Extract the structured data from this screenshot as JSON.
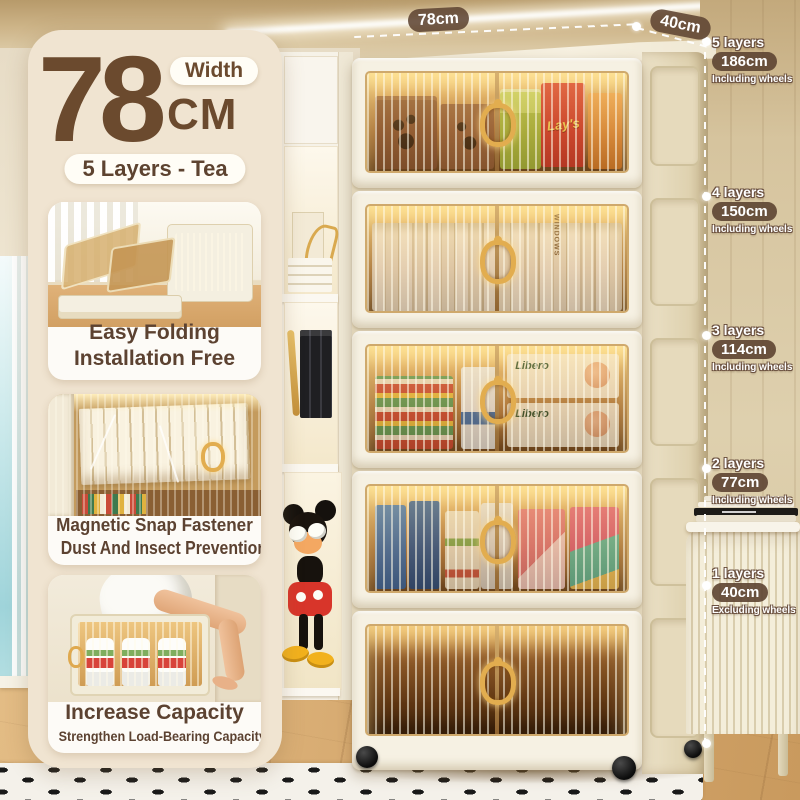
{
  "header": {
    "size_value": "78",
    "size_unit": "CM",
    "size_label": "Width",
    "variant": "5 Layers - Tea"
  },
  "features": [
    {
      "line1": "Easy Folding",
      "line2": "Installation Free"
    },
    {
      "line1": "Magnetic Snap Fastener",
      "line2": "Dust And Insect Prevention"
    },
    {
      "line1": "Increase Capacity",
      "line2": "Strengthen Load-Bearing Capacity"
    }
  ],
  "dimensions": {
    "width": "78cm",
    "depth": "40cm"
  },
  "height_markers": [
    {
      "layers": "5 layers",
      "height": "186cm",
      "note": "Including wheels"
    },
    {
      "layers": "4 layers",
      "height": "150cm",
      "note": "Including wheels"
    },
    {
      "layers": "3 layers",
      "height": "114cm",
      "note": "Including wheels"
    },
    {
      "layers": "2 layers",
      "height": "77cm",
      "note": "Including wheels"
    },
    {
      "layers": "1 layers",
      "height": "40cm",
      "note": "Excluding wheels"
    }
  ],
  "brands": {
    "chips": "Lay's",
    "diapers": "Libero",
    "book_spine": "WINDOWS"
  },
  "colors": {
    "accent_brown": "#6b4a2e",
    "pill_brown": "#604634",
    "panel_cream": "#f0e4d1",
    "cabinet_cream": "#f6f1e3",
    "door_amber": "#b07a3e",
    "glow": "#f9d68c"
  }
}
